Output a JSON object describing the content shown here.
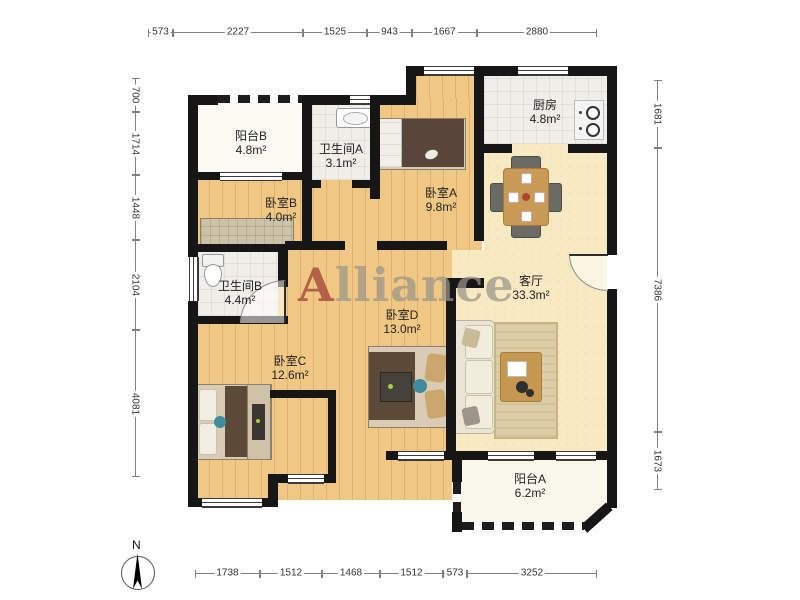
{
  "title": "apartment-floor-plan",
  "watermark": {
    "first_letter": "A",
    "rest": "lliance"
  },
  "compass": {
    "label": "N"
  },
  "rooms": [
    {
      "id": "balcony-b",
      "name": "阳台B",
      "area": "4.8m²"
    },
    {
      "id": "bathroom-a",
      "name": "卫生间A",
      "area": "3.1m²"
    },
    {
      "id": "bedroom-b",
      "name": "卧室B",
      "area": "4.0m²"
    },
    {
      "id": "bedroom-a",
      "name": "卧室A",
      "area": "9.8m²"
    },
    {
      "id": "kitchen",
      "name": "厨房",
      "area": "4.8m²"
    },
    {
      "id": "bathroom-b",
      "name": "卫生间B",
      "area": "4.4m²"
    },
    {
      "id": "living-room",
      "name": "客厅",
      "area": "33.3m²"
    },
    {
      "id": "bedroom-d",
      "name": "卧室D",
      "area": "13.0m²"
    },
    {
      "id": "bedroom-c",
      "name": "卧室C",
      "area": "12.6m²"
    },
    {
      "id": "balcony-a",
      "name": "阳台A",
      "area": "6.2m²"
    }
  ],
  "dimensions": {
    "top": [
      "573",
      "2227",
      "1525",
      "943",
      "1667",
      "2880"
    ],
    "bottom": [
      "1738",
      "1512",
      "1468",
      "1512",
      "573",
      "3252"
    ],
    "left": [
      "700",
      "1714",
      "1448",
      "2104",
      "4081"
    ],
    "right": [
      "1681",
      "7386",
      "1673"
    ]
  },
  "colors": {
    "wall": "#161616",
    "wood_floor": "#F0C883",
    "cream_floor": "#F7E9C2",
    "tile_floor": "#EFEEE9",
    "watermark_red": "#9E3A32",
    "watermark_gray": "#9A958A"
  }
}
